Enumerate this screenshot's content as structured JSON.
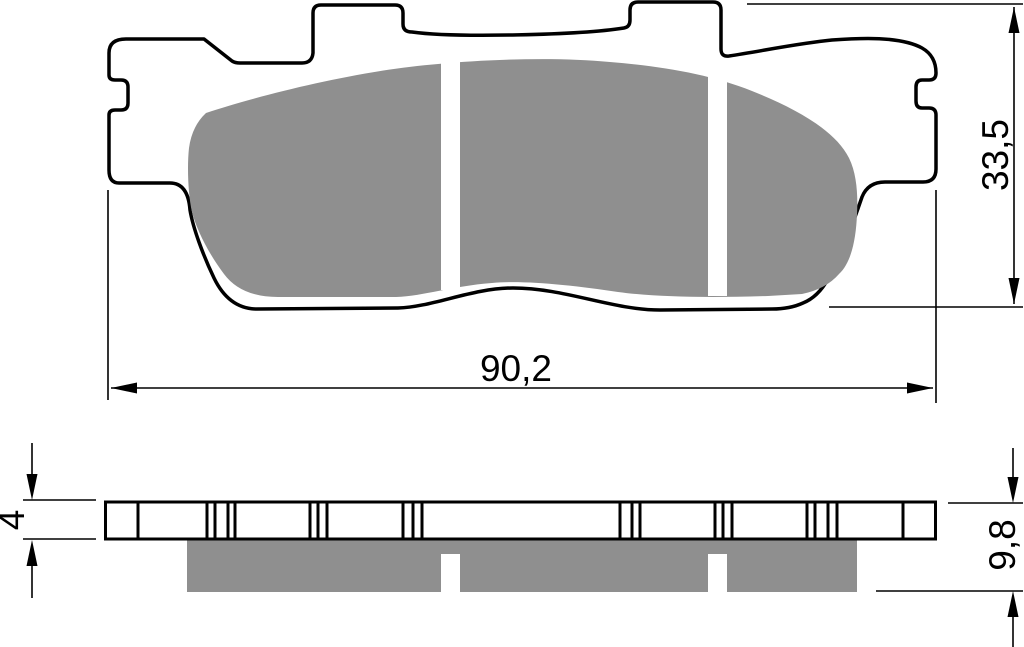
{
  "drawing": {
    "subject": "brake-pad-technical-drawing",
    "views": {
      "front": "front-outline-with-friction-material",
      "side": "edge-profile-with-backing-plate"
    },
    "friction_segments": 3
  },
  "dimensions": {
    "width": {
      "label": "90,2",
      "orientation": "horizontal"
    },
    "height": {
      "label": "33,5",
      "orientation": "vertical"
    },
    "backing_thickness": {
      "label": "4",
      "orientation": "vertical"
    },
    "overall_thickness": {
      "label": "9,8",
      "orientation": "vertical"
    }
  },
  "colors": {
    "outline": "#000000",
    "friction_material": "#8f8f8f",
    "background": "#ffffff"
  }
}
